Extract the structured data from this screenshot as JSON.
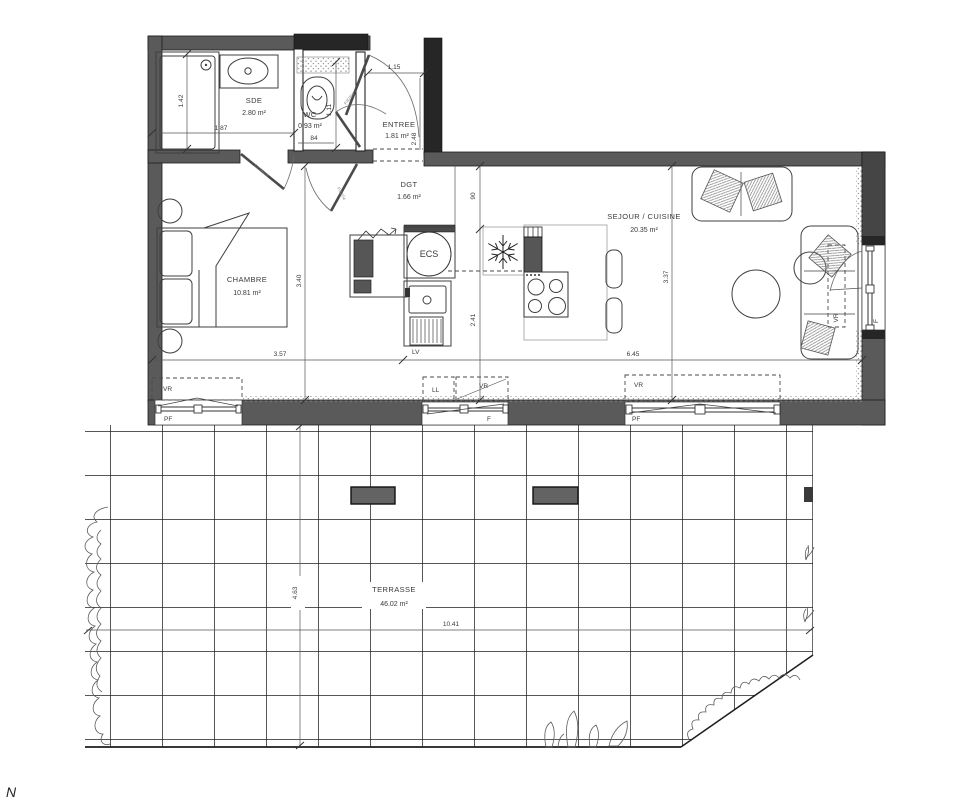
{
  "rooms": {
    "sde": {
      "name": "SDE",
      "area": "2.80 m²"
    },
    "wc": {
      "name": "WC",
      "area": "0.93 m²"
    },
    "entree": {
      "name": "ENTREE",
      "area": "1.81 m²"
    },
    "dgt": {
      "name": "DGT",
      "area": "1.66 m²"
    },
    "chambre": {
      "name": "CHAMBRE",
      "area": "10.81 m²"
    },
    "sejour": {
      "name": "SEJOUR / CUISINE",
      "area": "20.35 m²"
    },
    "terrasse": {
      "name": "TERRASSE",
      "area": "46.02 m²"
    }
  },
  "dims": {
    "shower_width": "1.42",
    "sde_width": "1.87",
    "wc_width": "84",
    "wc_depth": "1.11",
    "entree_width": "1.15",
    "entree_depth": "2.48",
    "dgt_passage": "90",
    "chambre_depth": "3.40",
    "chambre_width": "3.57",
    "cuisine_depth": "2.41",
    "sejour_depth": "3.37",
    "sejour_width": "6.45",
    "terrasse_depth": "4.63",
    "terrasse_width": "10.41"
  },
  "labels": {
    "water_heater": "ECS",
    "dishwasher": "LV",
    "washing_machine": "LL",
    "roller_shutter": "VR",
    "french_window": "PF",
    "window": "F",
    "north": "N",
    "door_sde_ref": "CL.050 d",
    "door_ref": "P.82/04"
  },
  "colors": {
    "wall": "#5a5a5a",
    "wall_dark": "#262626",
    "line": "#2f2f2f",
    "text": "#3a3a3a",
    "background": "#ffffff"
  }
}
